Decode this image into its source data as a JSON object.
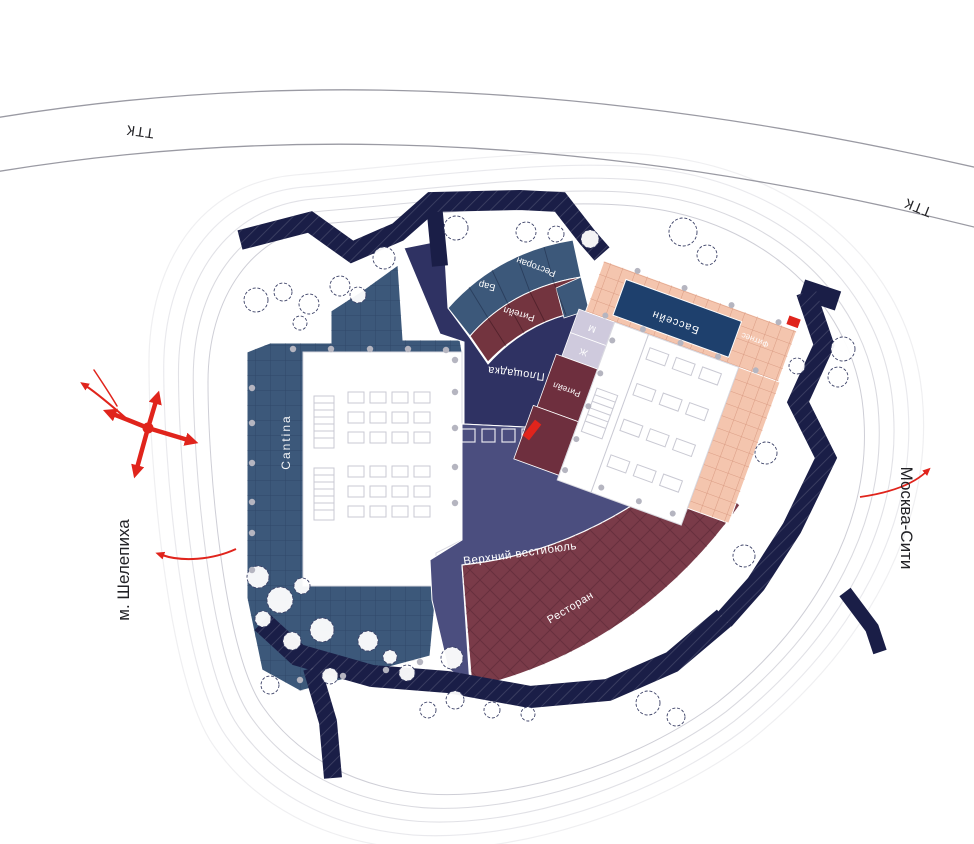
{
  "roads": {
    "ttk_left": "ТТК",
    "ttk_right": "ТТК"
  },
  "context": {
    "metro": "м. Шелепиха",
    "city": "Москва-Сити"
  },
  "zones": {
    "cantina": "Cantina",
    "plaza": "Площадка",
    "bar": "Бар",
    "restaurant_top": "Ресторан",
    "retail_top": "Ритейл",
    "pool": "Бассейн",
    "fitness": "Фитнес",
    "retail_side": "Ритейл",
    "wc_m": "М",
    "wc_w": "Ж",
    "upper_lobby": "Верхний вестибюль",
    "restaurant_bottom": "Ресторан"
  },
  "colors": {
    "accent_red": "#e0241c",
    "path_navy": "#1a1e47",
    "plaza_navy": "#2f3263",
    "lobby_indigo": "#4b4e7f",
    "terrace_blue": "#3c587a",
    "burgundy": "#7a3b49",
    "pool_blue": "#1e406d",
    "deck_pink": "#f4c5ae",
    "lavender": "#cfcadd"
  }
}
